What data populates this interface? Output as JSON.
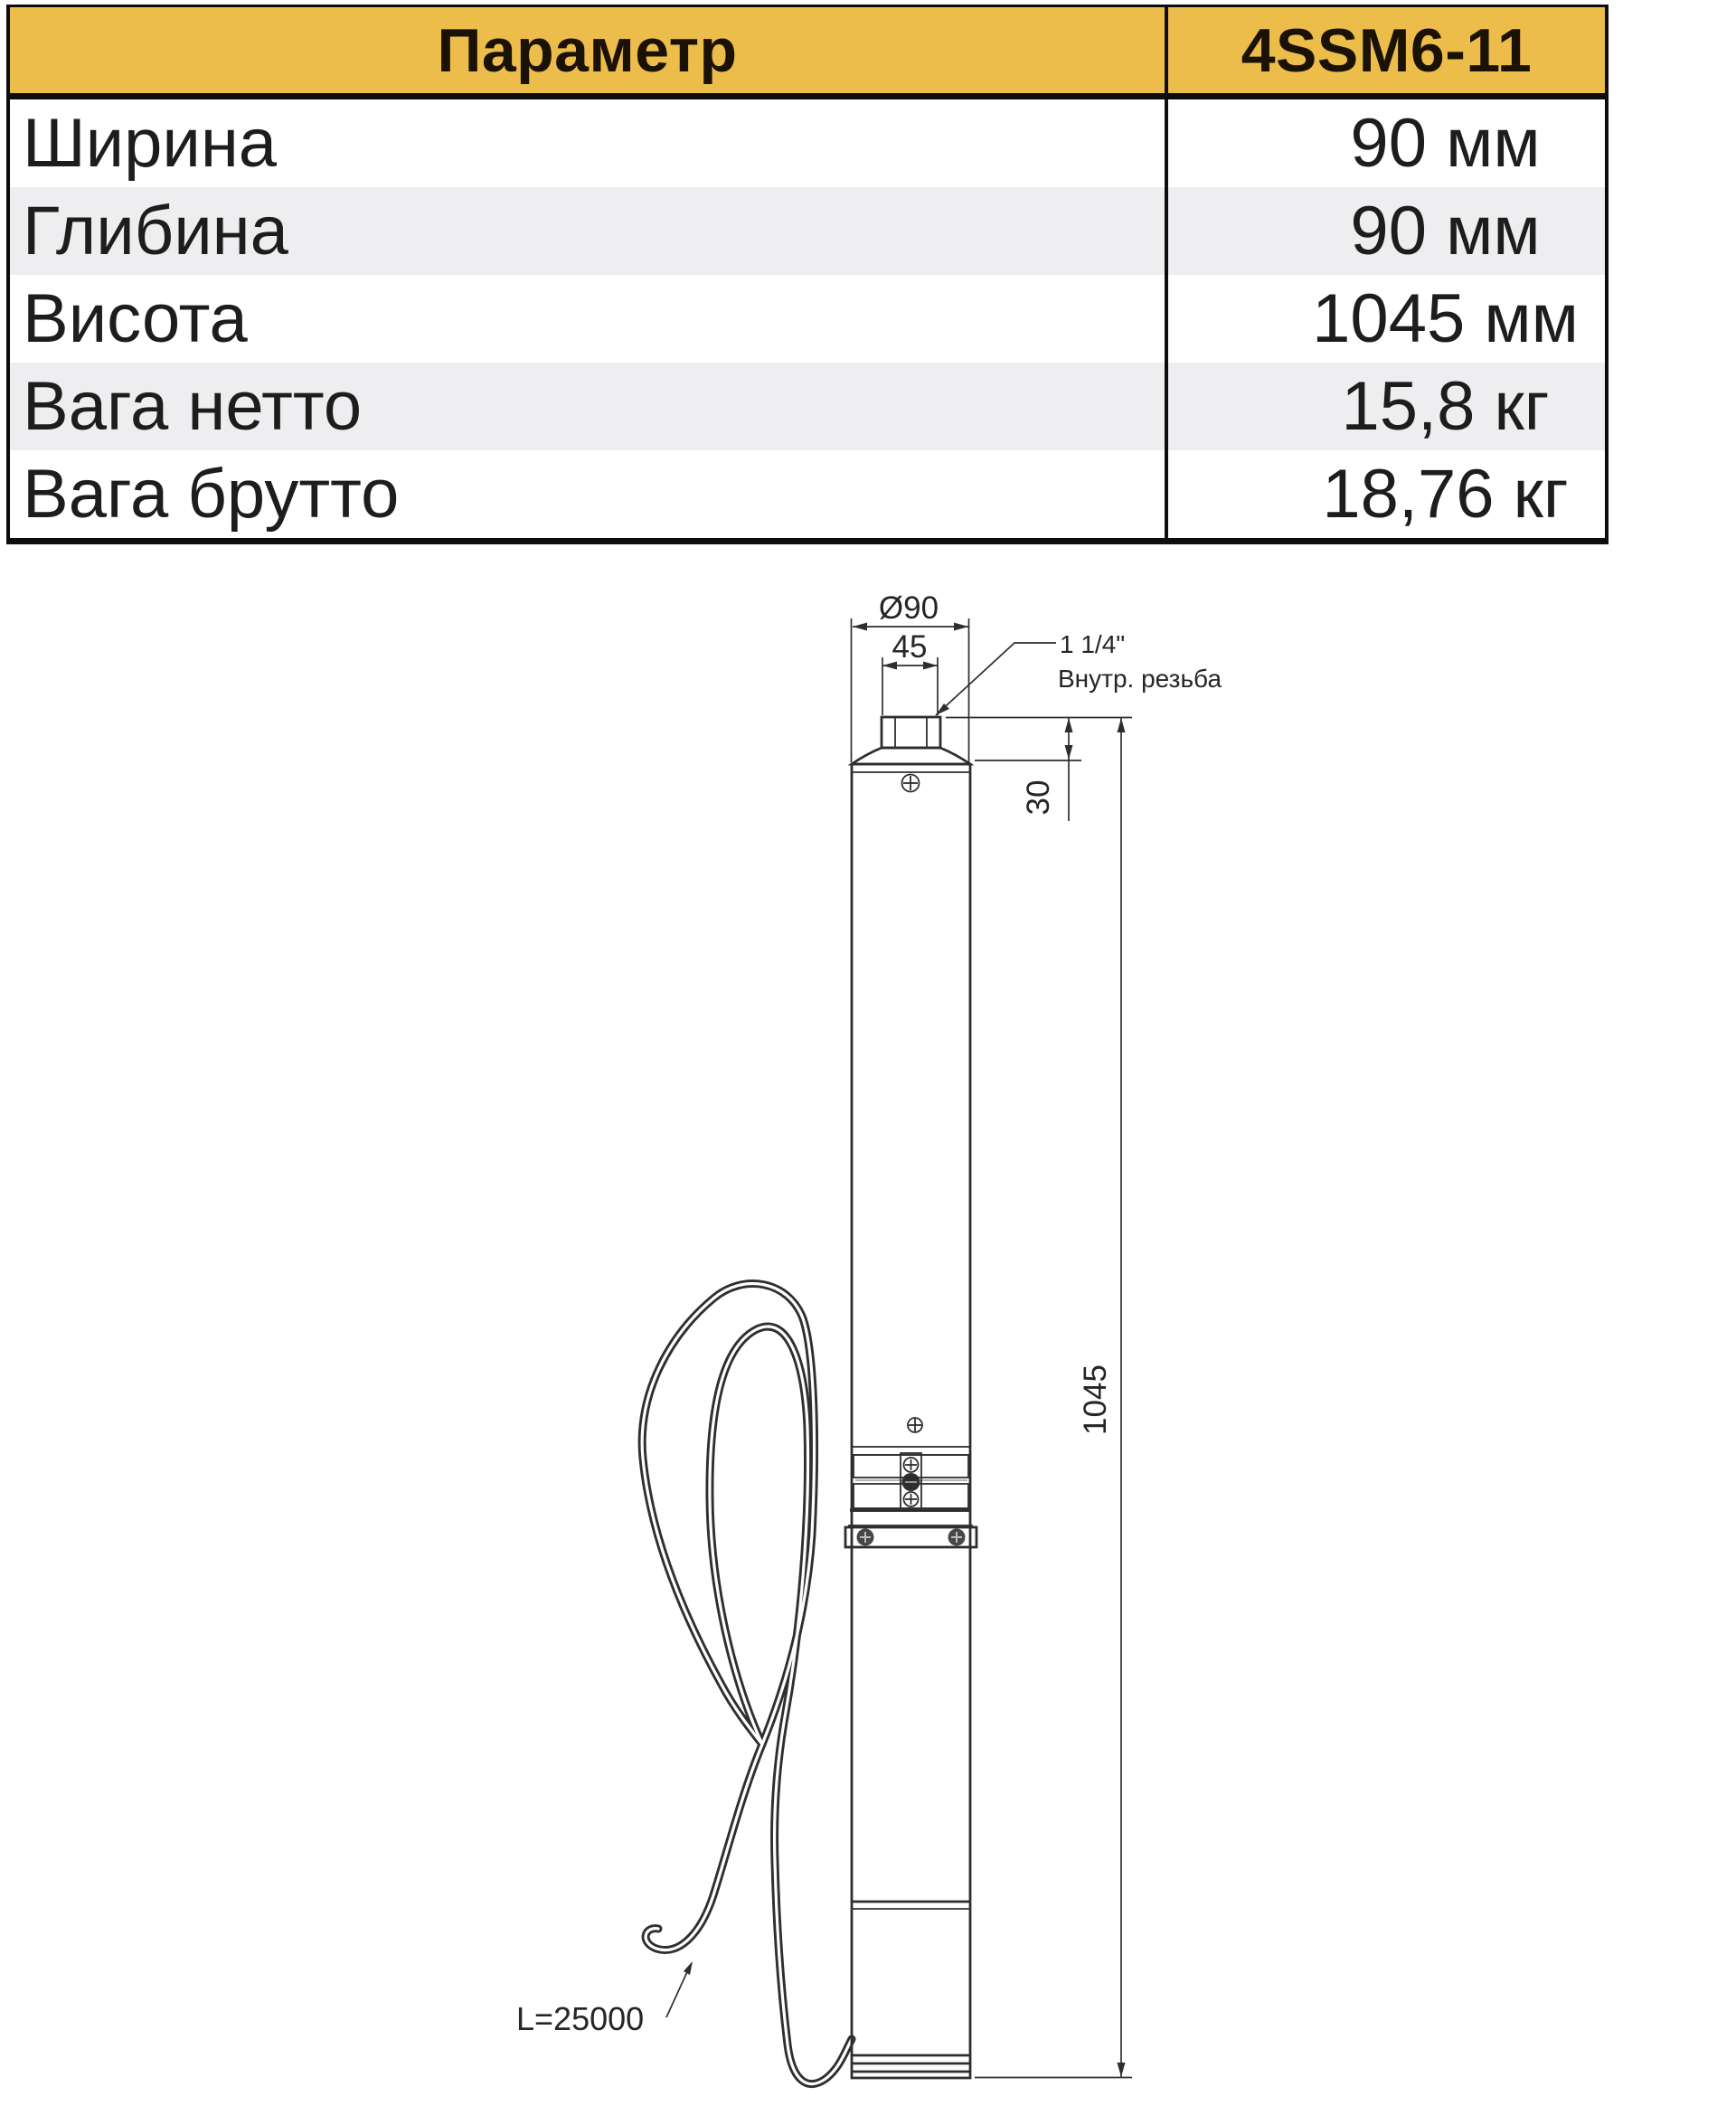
{
  "colors": {
    "header_bg": "#edbd4b",
    "stripe_bg": "#eeeef0",
    "table_border": "#0d0d0d",
    "drawing_ink": "#2e2e2e"
  },
  "table": {
    "header": {
      "param": "Параметр",
      "model": "4SSM6-11"
    },
    "rows": [
      {
        "label": "Ширина",
        "value": "90 мм"
      },
      {
        "label": "Глибина",
        "value": "90 мм"
      },
      {
        "label": "Висота",
        "value": "1045 мм"
      },
      {
        "label": "Вага нетто",
        "value": "15,8 кг"
      },
      {
        "label": "Вага брутто",
        "value": "18,76 кг"
      }
    ]
  },
  "drawing": {
    "labels": {
      "diameter": "Ø90",
      "thread_width": "45",
      "thread_size": "1 1/4\"",
      "thread_note": "Внутр. резьба",
      "top_offset": "30",
      "total_height": "1045",
      "cable_length": "L=25000"
    }
  }
}
